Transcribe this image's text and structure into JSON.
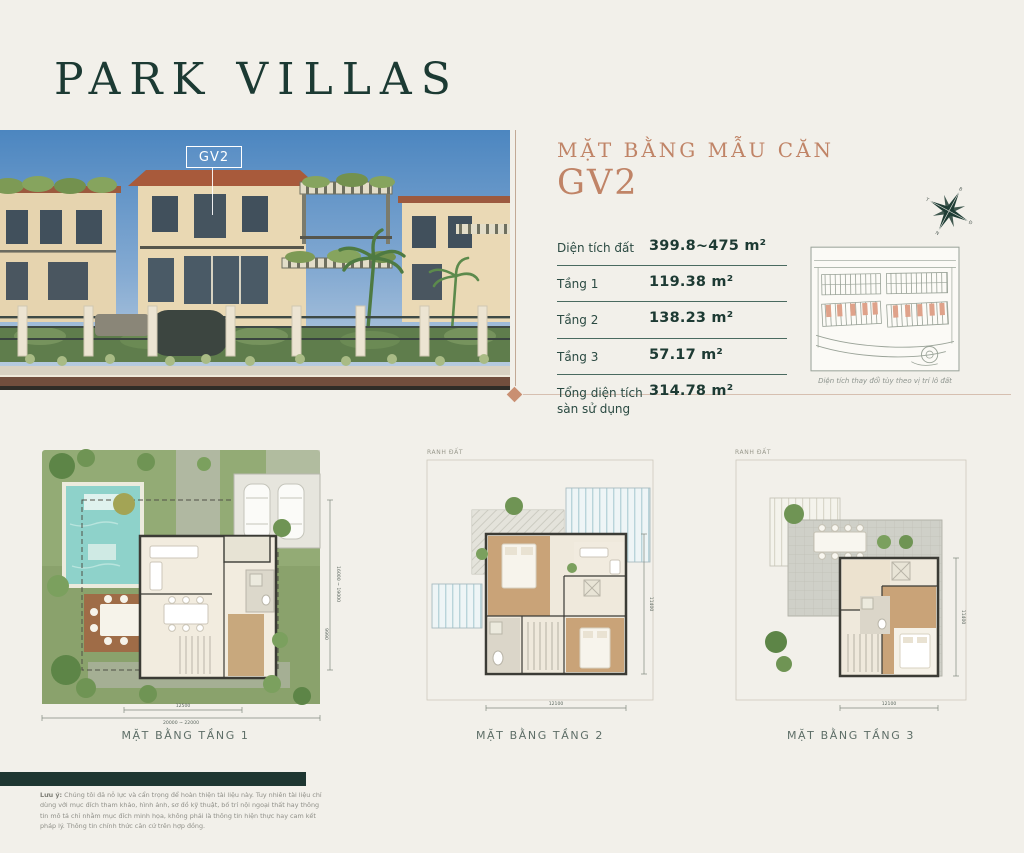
{
  "page": {
    "title": "PARK VILLAS"
  },
  "hero": {
    "tag": "GV2"
  },
  "spec": {
    "heading_line1": "MẶT BẰNG MẪU CĂN",
    "heading_line2": "GV2",
    "rows": [
      {
        "label": "Diện tích đất",
        "value": "399.8~475 m²"
      },
      {
        "label": "Tầng 1",
        "value": "119.38 m²"
      },
      {
        "label": "Tầng 2",
        "value": "138.23 m²"
      },
      {
        "label": "Tầng 3",
        "value": "57.17 m²"
      },
      {
        "label": "Tổng diện tích sàn sử dụng",
        "value": "314.78 m²"
      }
    ],
    "sitemap_caption": "Diện tích thay đổi tùy theo vị trí lô đất"
  },
  "compass": {
    "north": "B",
    "east": "Đ",
    "south": "N",
    "west": "T"
  },
  "plans": {
    "items": [
      {
        "label": "MẶT BẰNG TẦNG 1",
        "dim_bottom_1": "12500",
        "dim_bottom_2": "20000 ~ 22000",
        "dim_right_1": "9990",
        "dim_right_2": "16000 ~ 19000"
      },
      {
        "label": "MẶT BẰNG TẦNG 2",
        "boundary": "RANH ĐẤT",
        "dim_bottom": "12100",
        "dim_right": "11400"
      },
      {
        "label": "MẶT BẰNG TẦNG 3",
        "boundary": "RANH ĐẤT",
        "dim_bottom": "12100",
        "dim_right": "11400"
      }
    ]
  },
  "footer": {
    "note_lead": "Lưu ý:",
    "note_body": " Chúng tôi đã nỗ lực và cẩn trọng để hoàn thiện tài liệu này. Tuy nhiên tài liệu chỉ dùng với mục đích tham khảo, hình ảnh, sơ đồ kỹ thuật, bố trí nội ngoại thất hay thông tin mô tả chỉ nhằm mục đích minh họa, không phải là thông tin hiện thực hay cam kết pháp lý. Thông tin chính thức căn cứ trên hợp đồng."
  },
  "colors": {
    "teal": "#1d3a33",
    "copper": "#bf8467",
    "cream": "#f2f0ea"
  }
}
